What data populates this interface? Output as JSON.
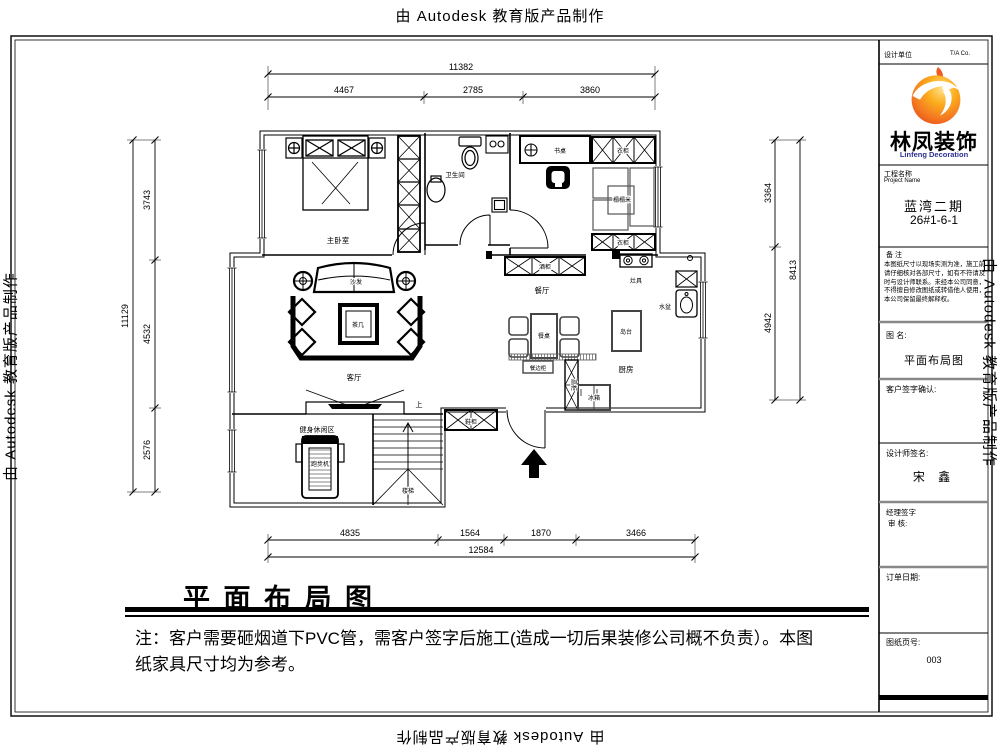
{
  "watermark": {
    "text": "由 Autodesk 教育版产品制作"
  },
  "title_block": {
    "header_left": "设计单位",
    "header_right": "T/A  Co.",
    "brand_cn": "林凤装饰",
    "brand_en": "Linfeng Decoration",
    "accent_orange": "#f26c21",
    "brand_blue": "#2e3192",
    "project_label_cn": "工程名称",
    "project_label_en": "Project Name",
    "project_name": "蓝湾二期",
    "project_no": "26#1-6-1",
    "notes_label": "备 注",
    "notes_text": "本图纸尺寸以现场实测为准，施工前请仔细核对各部尺寸，如有不符请及时与设计师联系。未经本公司同意，不得擅自修改图纸或转借他人使用，本公司保留最终解释权。",
    "drawing_name_label": "图 名:",
    "drawing_name": "平面布局图",
    "client_sign_label": "客户签字确认:",
    "designer_label": "设计师签名:",
    "designer_name": "宋 鑫",
    "manager_label": "经理签字",
    "audit_label": "审 核:",
    "order_date_label": "订单日期:",
    "page_label": "图纸页号:",
    "page_number": "003"
  },
  "plan": {
    "rooms": {
      "master_bedroom": "主卧室",
      "bathroom": "卫生间",
      "living_room": "客厅",
      "dining_room": "餐厅",
      "kitchen": "厨房",
      "fitness_area": "健身休闲区",
      "stairs": "楼梯"
    },
    "furniture": {
      "desk": "书桌",
      "wardrobe_top": "衣柜",
      "wardrobe_bottom": "衣柜",
      "tatami": "榻榻米",
      "sofa": "沙发",
      "coffee_table": "茶几",
      "dining_table": "餐桌",
      "sideboard": "餐边柜",
      "wine_cabinet": "酒柜",
      "stove": "灶具",
      "island": "岛台",
      "sink": "水盆",
      "fridge": "冰箱",
      "tall_cabinet": "高柜",
      "treadmill": "跑步机",
      "shoe_cabinet": "鞋柜"
    },
    "stairs_up": "上"
  },
  "dims": {
    "top": {
      "overall": "11382",
      "seg1": "4467",
      "seg2": "2785",
      "seg3": "3860"
    },
    "left": {
      "overall": "11129",
      "seg1": "3743",
      "seg2": "4532",
      "seg3": "2576"
    },
    "right": {
      "overall": "8413",
      "seg1": "3364",
      "seg2": "4942"
    },
    "bottom": {
      "overall": "12584",
      "seg1": "4835",
      "seg2": "1564",
      "seg3": "1870",
      "seg4": "3466"
    }
  },
  "footer": {
    "title": "平 面 布 局 图",
    "note_line1": "注：客户需要砸烟道下PVC管，需客户签字后施工(造成一切后果装修公司概不负责）。本图",
    "note_line2": "纸家具尺寸均为参考。"
  }
}
